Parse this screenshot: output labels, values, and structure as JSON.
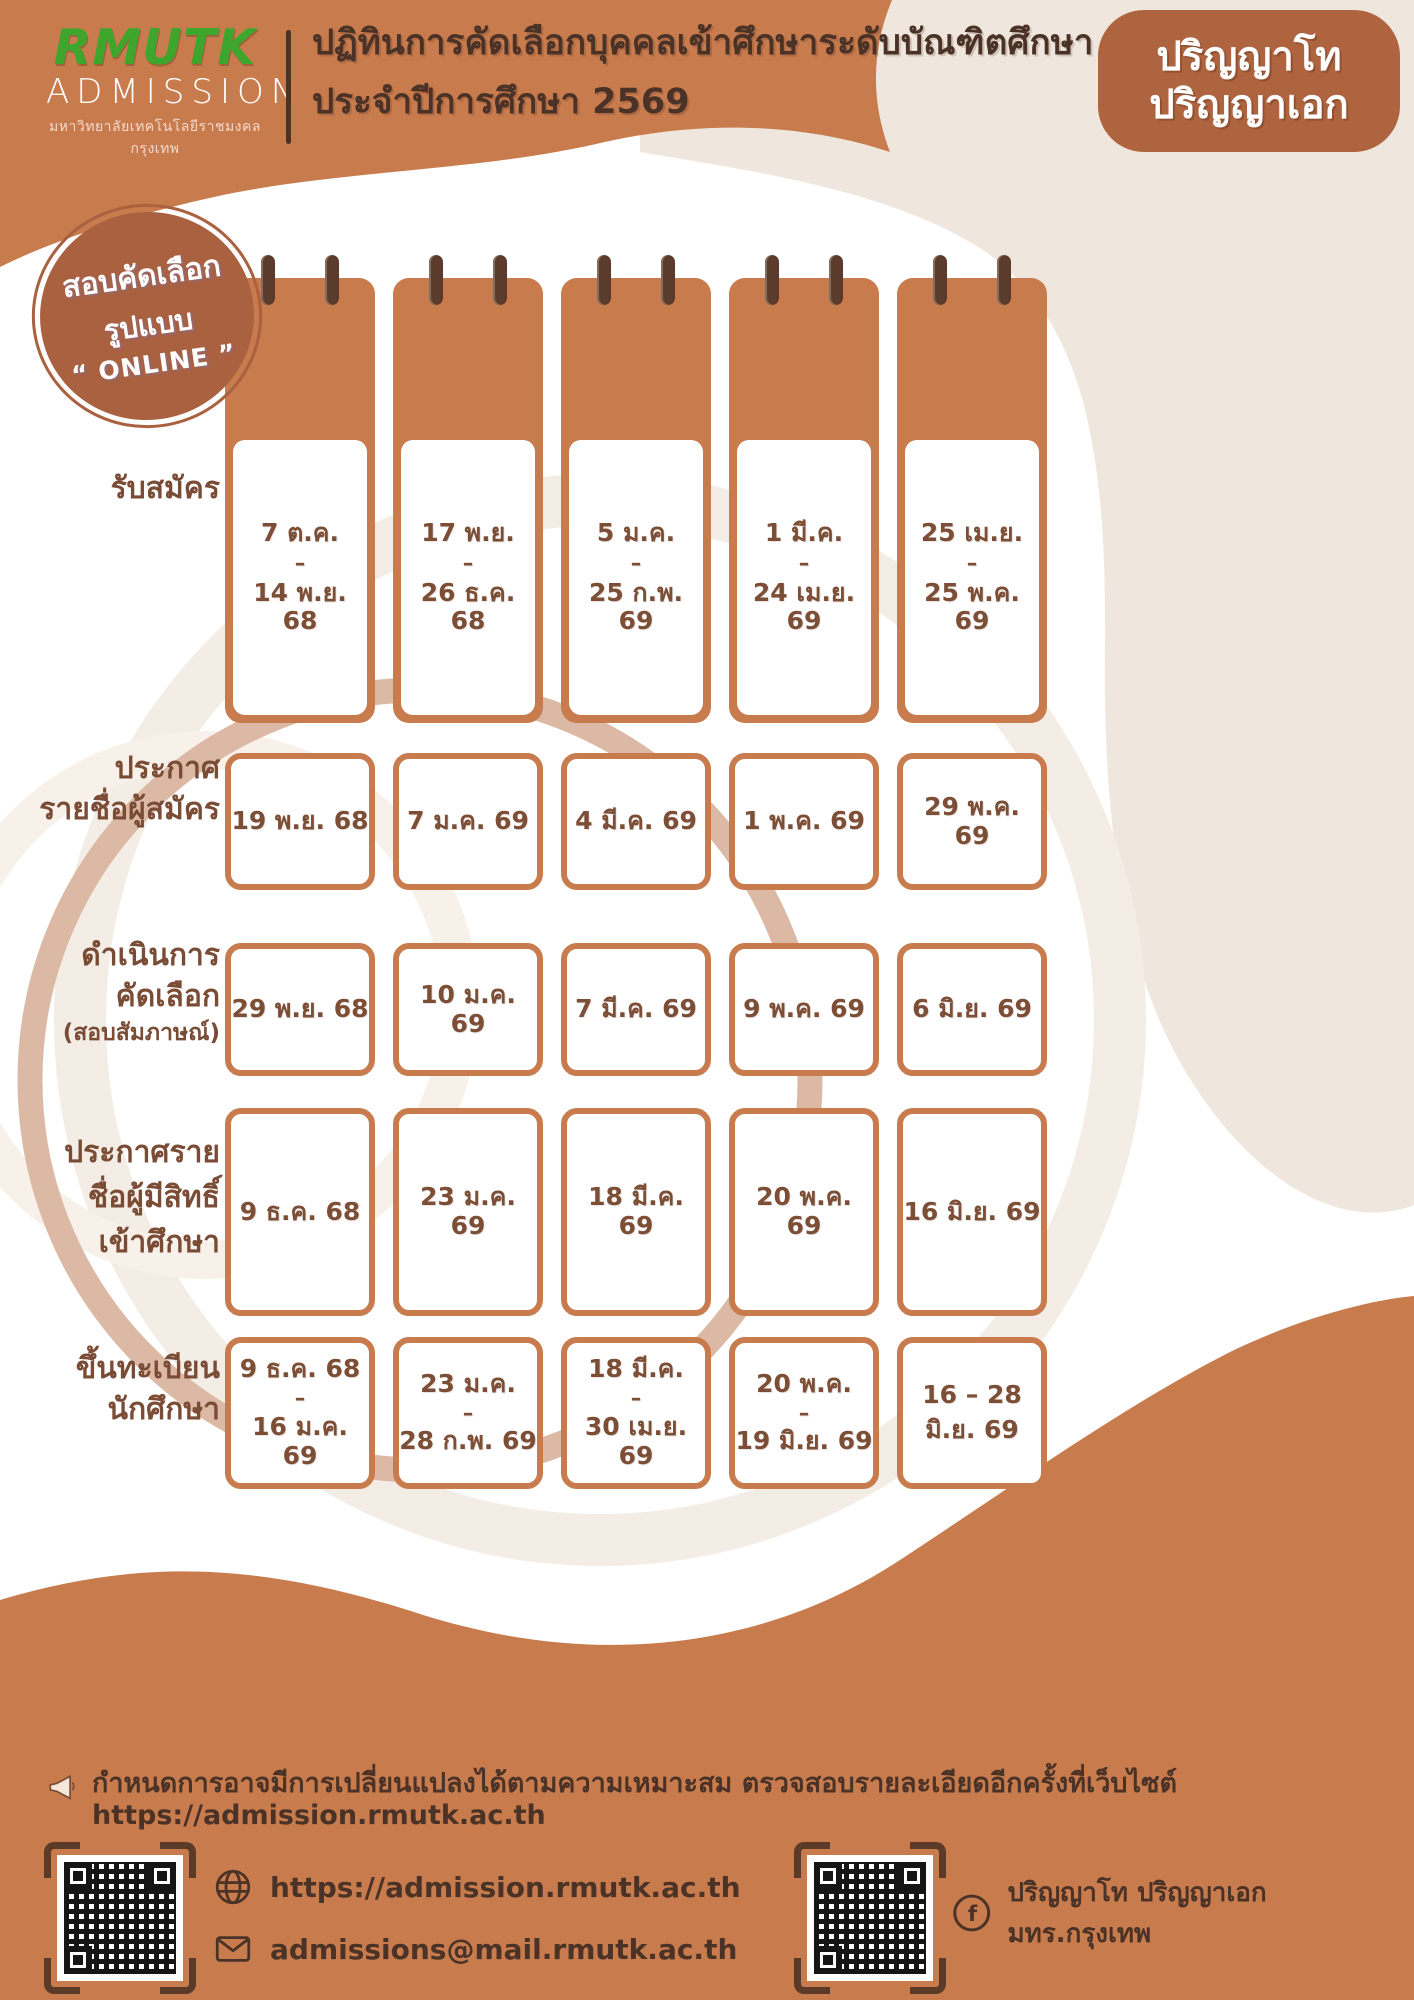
{
  "colors": {
    "orange": "#C87B4D",
    "orange_dark": "#AF6440",
    "cream": "#EFE7DD",
    "brown_dark": "#4B3226",
    "brown_text": "#7C4E36",
    "logo_green": "#3EA62C",
    "ring_rose": "#DCB9A5",
    "ring_pale": "#F3ECE3"
  },
  "header": {
    "logo_brand": "RMUTK",
    "logo_sub": "ADMISSION",
    "logo_org": "มหาวิทยาลัยเทคโนโลยีราชมงคลกรุงเทพ",
    "title_line1": "ปฏิทินการคัดเลือกบุคคลเข้าศึกษาระดับบัณฑิตศึกษา",
    "title_line2": "ประจำปีการศึกษา 2569",
    "degree_line1": "ปริญญาโท",
    "degree_line2": "ปริญญาเอก"
  },
  "online_badge": {
    "line1": "สอบคัดเลือก",
    "line2": "รูปแบบ",
    "line3": "“ ONLINE ”"
  },
  "schedule": {
    "rows": [
      {
        "label_lines": [
          "รับสมัคร"
        ],
        "cells": [
          {
            "lines": [
              "7 ต.ค.",
              "–",
              "14 พ.ย. 68"
            ]
          },
          {
            "lines": [
              "17 พ.ย.",
              "–",
              "26 ธ.ค. 68"
            ]
          },
          {
            "lines": [
              "5 ม.ค.",
              "–",
              "25 ก.พ. 69"
            ]
          },
          {
            "lines": [
              "1 มี.ค.",
              "–",
              "24 เม.ย. 69"
            ]
          },
          {
            "lines": [
              "25 เม.ย.",
              "–",
              "25 พ.ค. 69"
            ]
          }
        ]
      },
      {
        "label_lines": [
          "ประกาศ",
          "รายชื่อผู้สมัคร"
        ],
        "cells": [
          {
            "lines": [
              "19 พ.ย. 68"
            ]
          },
          {
            "lines": [
              "7 ม.ค. 69"
            ]
          },
          {
            "lines": [
              "4 มี.ค. 69"
            ]
          },
          {
            "lines": [
              "1 พ.ค. 69"
            ]
          },
          {
            "lines": [
              "29 พ.ค. 69"
            ]
          }
        ]
      },
      {
        "label_lines": [
          "ดำเนินการ",
          "คัดเลือก",
          "(สอบสัมภาษณ์)"
        ],
        "cells": [
          {
            "lines": [
              "29 พ.ย. 68"
            ]
          },
          {
            "lines": [
              "10 ม.ค. 69"
            ]
          },
          {
            "lines": [
              "7 มี.ค. 69"
            ]
          },
          {
            "lines": [
              "9 พ.ค. 69"
            ]
          },
          {
            "lines": [
              "6 มิ.ย. 69"
            ]
          }
        ]
      },
      {
        "label_lines": [
          "ประกาศราย",
          "ชื่อผู้มีสิทธิ์",
          "เข้าศึกษา"
        ],
        "cells": [
          {
            "lines": [
              "9 ธ.ค. 68"
            ]
          },
          {
            "lines": [
              "23 ม.ค. 69"
            ]
          },
          {
            "lines": [
              "18 มี.ค. 69"
            ]
          },
          {
            "lines": [
              "20 พ.ค. 69"
            ]
          },
          {
            "lines": [
              "16 มิ.ย. 69"
            ]
          }
        ]
      },
      {
        "label_lines": [
          "ขึ้นทะเบียน",
          "นักศึกษา"
        ],
        "cells": [
          {
            "lines": [
              "9 ธ.ค. 68",
              "–",
              "16 ม.ค. 69"
            ]
          },
          {
            "lines": [
              "23 ม.ค.",
              "–",
              "28 ก.พ. 69"
            ]
          },
          {
            "lines": [
              "18 มี.ค.",
              "–",
              "30 เม.ย. 69"
            ]
          },
          {
            "lines": [
              "20 พ.ค.",
              "–",
              "19 มิ.ย. 69"
            ]
          },
          {
            "lines": [
              "16 – 28",
              "มิ.ย. 69"
            ]
          }
        ]
      }
    ]
  },
  "footer": {
    "note_text": "กำหนดการอาจมีการเปลี่ยนแปลงได้ตามความเหมาะสม ตรวจสอบรายละเอียดอีกครั้งที่เว็บไซต์",
    "note_url": "https://admission.rmutk.ac.th",
    "website": "https://admission.rmutk.ac.th",
    "email": "admissions@mail.rmutk.ac.th",
    "facebook": "ปริญญาโท ปริญญาเอก มทร.กรุงเทพ"
  }
}
